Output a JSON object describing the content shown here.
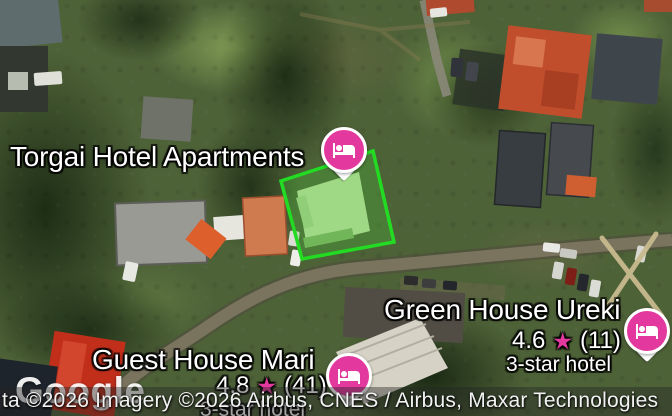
{
  "places": {
    "torgai": {
      "name": "Torgai Hotel Apartments"
    },
    "ureki": {
      "name": "Green House Ureki",
      "rating": "4.6",
      "star": "★",
      "reviews": "(11)",
      "category": "3-star hotel"
    },
    "mari": {
      "name": "Guest House Mari",
      "rating": "4.8",
      "star": "★",
      "reviews": "(41)",
      "category": "3-star hotel"
    }
  },
  "attribution": {
    "logo": "Google",
    "text": "ta ©2026 Imagery ©2026 Airbus, CNES / Airbus, Maxar Technologies"
  },
  "colors": {
    "pin_pink": "#E3399F",
    "star_pink": "#E3399F",
    "selection_green": "#22DB22"
  }
}
